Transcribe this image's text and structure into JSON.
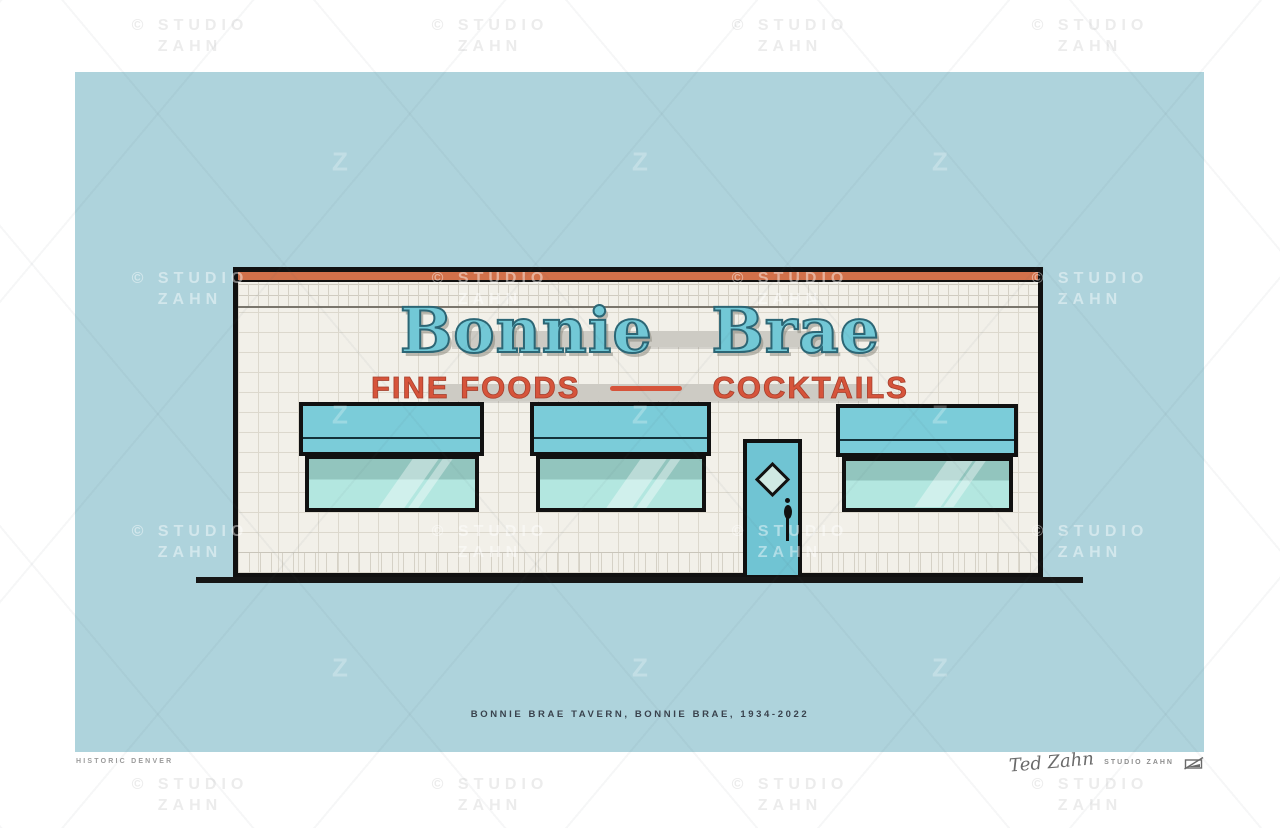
{
  "watermark": {
    "line1": "© STUDIO",
    "line2": "ZAHN",
    "logo_glyph": "Z"
  },
  "poster": {
    "background_color": "#aed3dc",
    "building": {
      "facade_color": "#f2f0e9",
      "stripe_color": "#d2714a",
      "outline_color": "#111111",
      "awning_color": "#7bccd9",
      "glass_color": "#b3e7e0",
      "door_color": "#70c4d3",
      "sign": {
        "name_text": "Bonnie Brae",
        "name_color": "#72c8d6",
        "tagline_left": "FINE FOODS",
        "tagline_right": "COCKTAILS",
        "tagline_color": "#d6543b"
      }
    },
    "caption": "BONNIE BRAE TAVERN, BONNIE BRAE, 1934-2022"
  },
  "footer": {
    "left_text": "HISTORIC DENVER",
    "signature": "Ted Zahn",
    "studio_text": "STUDIO ZAHN"
  }
}
